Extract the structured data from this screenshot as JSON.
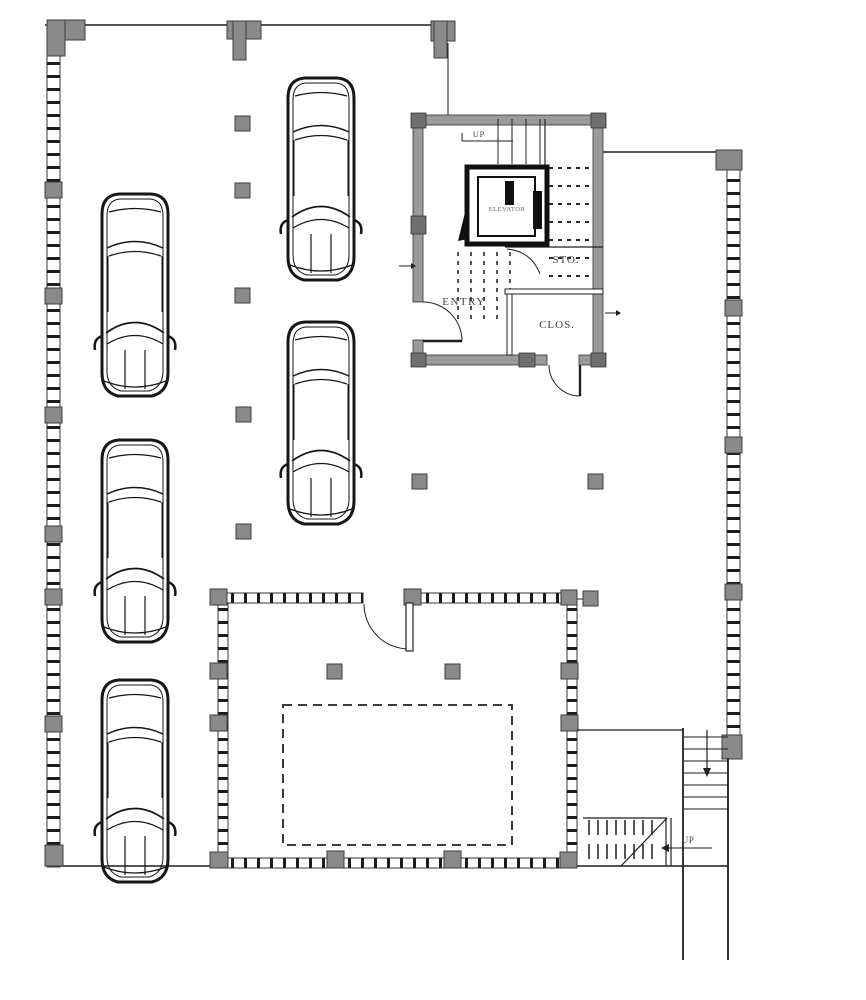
{
  "drawing": {
    "type": "architectural-floor-plan",
    "rooms": {
      "entry": "ENTRY",
      "closet": "CLOS.",
      "storage": "STO.",
      "elevator": "ELEVATOR"
    },
    "stairs": {
      "core_up": "UP",
      "exterior_up": "UP"
    },
    "parking": {
      "car_count": 5
    },
    "colors": {
      "background": "#ffffff",
      "wall_fill": "#9a9a9a",
      "column_fill": "#8a8a8a",
      "line": "#1f1f1f"
    }
  }
}
